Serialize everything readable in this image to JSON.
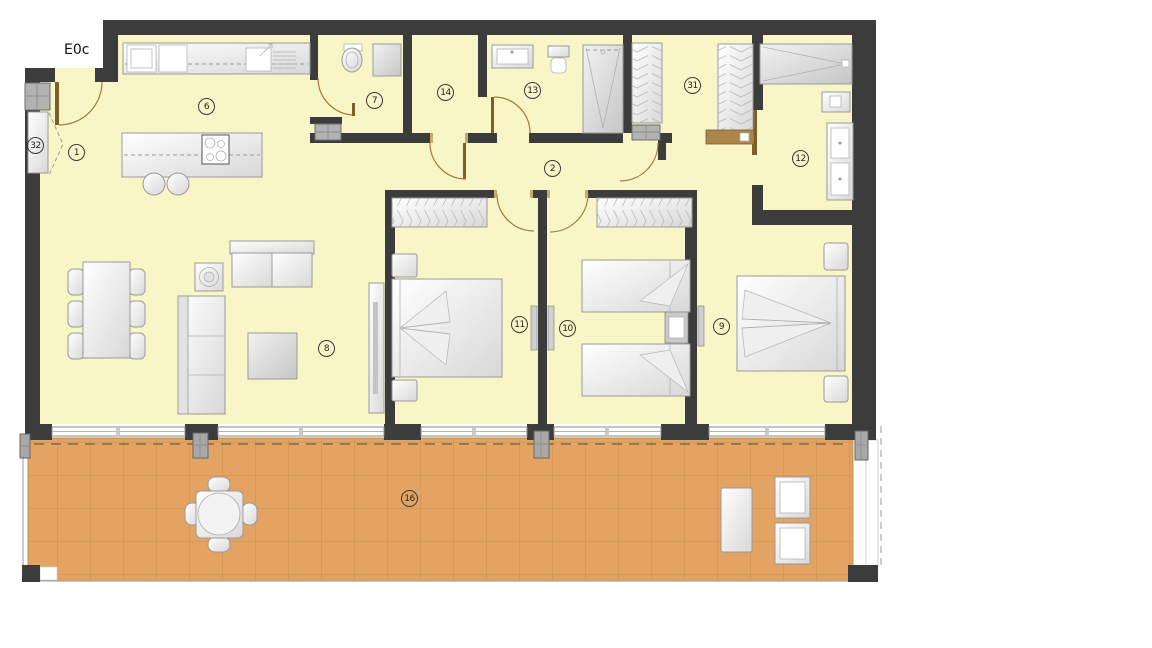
{
  "plan": {
    "label": "E0c"
  },
  "colors": {
    "wall": "#3c3c3c",
    "floor": "#f8f5c6",
    "terrace": "#e2a363",
    "terrace_line": "#c98f4d",
    "door": "#a07a3a",
    "door_leaf": "#7f5f28",
    "furniture_stroke": "#9a9a9a",
    "appliance_fill": "#b2b2b2",
    "badge_border": "#3a3a3a"
  },
  "rooms": {
    "entry": {
      "label": "1"
    },
    "hallway": {
      "label": "2"
    },
    "kitchen": {
      "label": "6"
    },
    "bathroom_guest": {
      "label": "7"
    },
    "living_room": {
      "label": "8"
    },
    "bedroom_master": {
      "label": "9"
    },
    "bedroom_twin": {
      "label": "10"
    },
    "bedroom_double": {
      "label": "11"
    },
    "bathroom_master": {
      "label": "12"
    },
    "bathroom_main": {
      "label": "13"
    },
    "storage": {
      "label": "14"
    },
    "terrace": {
      "label": "16"
    },
    "dressing": {
      "label": "31"
    },
    "utility": {
      "label": "32"
    }
  }
}
